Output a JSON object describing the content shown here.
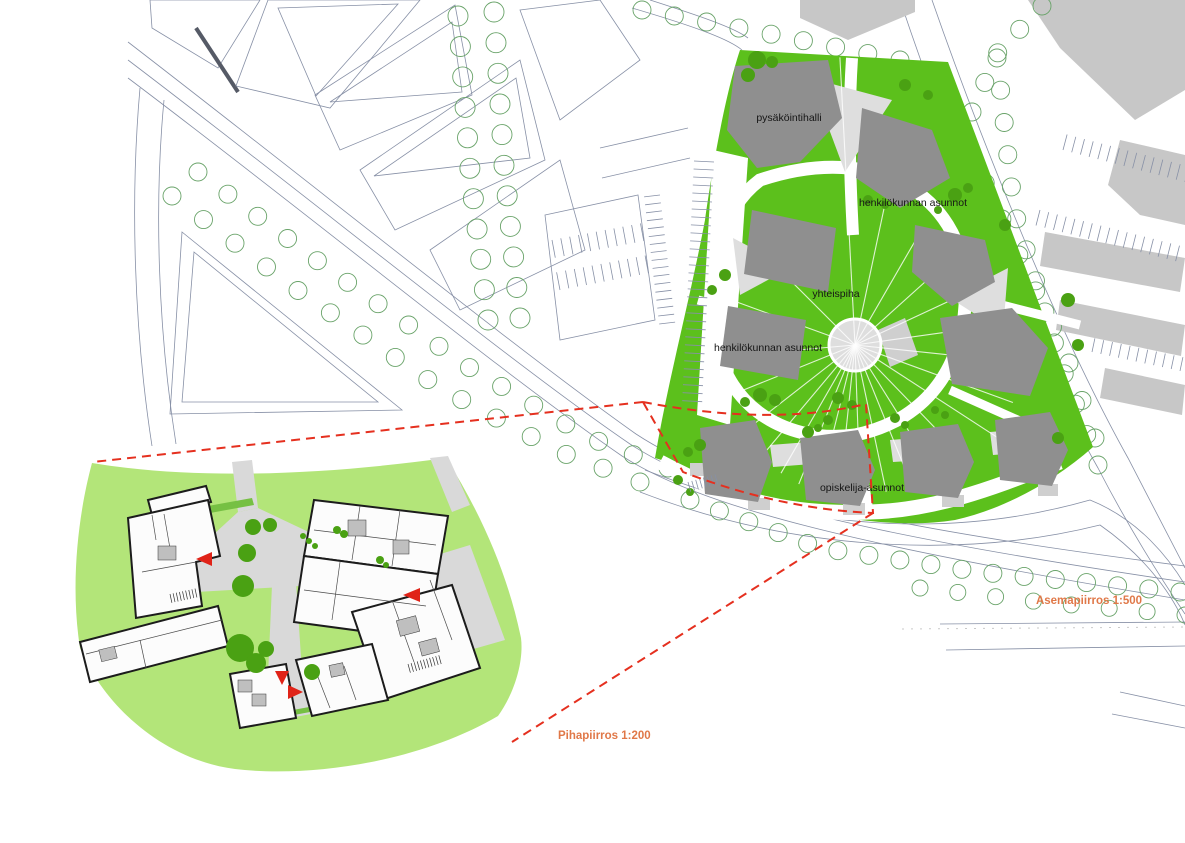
{
  "site_plan": {
    "caption": "Asemapiirros 1:500",
    "labels": {
      "parking_hall": "pysäköintihalli",
      "staff_apartments_ne": "henkilökunnan asunnot",
      "shared_courtyard": "yhteispiha",
      "staff_apartments_w": "henkilökunnan asunnot",
      "student_apartments": "opiskelija-asunnot"
    }
  },
  "courtyard_plan": {
    "caption": "Pihapiirros 1:200"
  },
  "colors": {
    "site_green": "#5cc01c",
    "courtyard_green": "#b3e579",
    "tree_green": "#4aa113",
    "building_grey": "#8f8f8f",
    "context_grey": "#c7c7c7",
    "paving_grey": "#d9d9d9",
    "outline_blue_grey": "#8790a6",
    "tree_outline": "#69a369",
    "highlight_red": "#e5301f",
    "caption_orange": "#e07848"
  }
}
